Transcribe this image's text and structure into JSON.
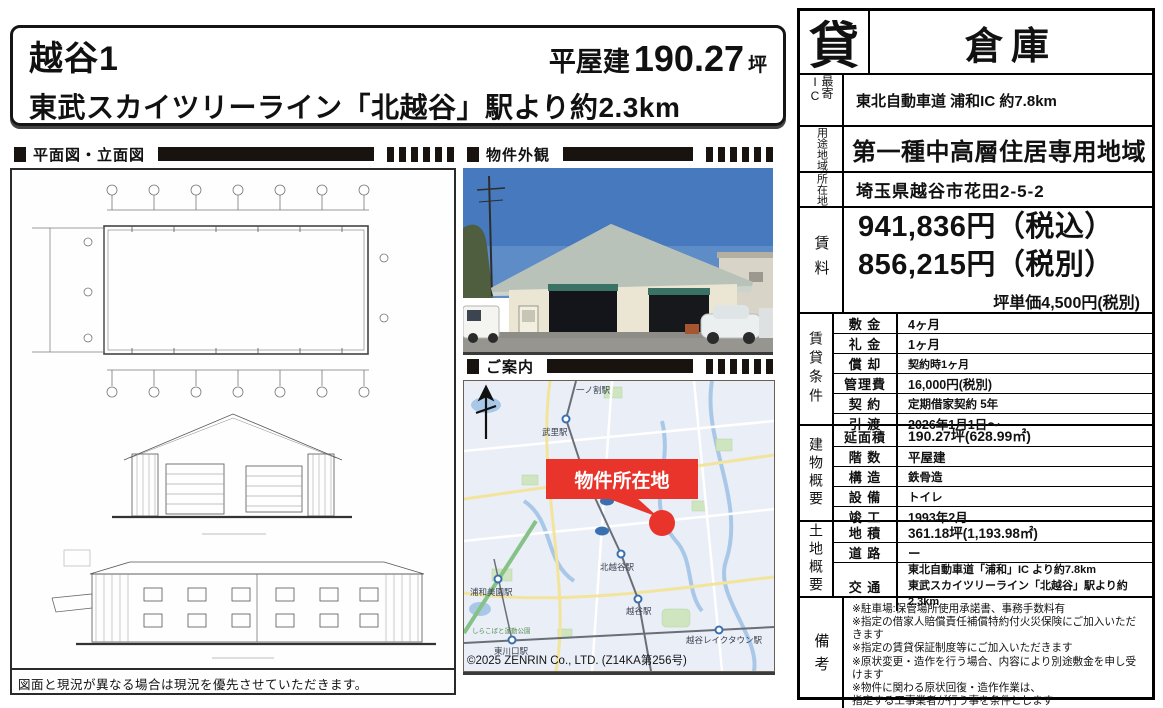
{
  "header": {
    "title": "越谷1",
    "building_type": "平屋建",
    "area_value": "190.27",
    "area_unit": "坪",
    "subtitle": "東武スカイツリーライン「北越谷」駅より約2.3km"
  },
  "sections": {
    "plan": {
      "title": "平面図・立面図",
      "note": "図面と現況が異なる場合は現況を優先させていただきます。"
    },
    "photo": {
      "title": "物件外観"
    },
    "map": {
      "title": "ご案内"
    }
  },
  "map": {
    "callout": "物件所在地",
    "copyright": "©2025 ZENRIN Co., LTD.  (Z14KA第256号)",
    "stations": [
      "一ノ割駅",
      "武里駅",
      "北越谷駅",
      "越谷駅",
      "浦和美園駅",
      "東川口駅",
      "越谷レイクタウン駅"
    ],
    "places": [
      "しらこばと運動公園"
    ]
  },
  "colors": {
    "accent_red": "#e8342b",
    "bar_black": "#191310"
  },
  "table": {
    "badge": "貸",
    "category": "倉庫",
    "nearest_ic": {
      "label": "最寄IC",
      "value": "東北自動車道 浦和IC 約7.8km"
    },
    "zoning": {
      "label": "用途地域",
      "value": "第一種中高層住居専用地域"
    },
    "address": {
      "label": "所在地",
      "value": "埼玉県越谷市花田2-5-2"
    },
    "rent": {
      "label": "賃料",
      "incl_tax": "941,836円（税込）",
      "excl_tax": "856,215円（税別）",
      "unit_price": "坪単価4,500円(税別)"
    },
    "lease": {
      "label": "賃貸条件",
      "rows": [
        {
          "label": "敷 金",
          "value": "4ヶ月"
        },
        {
          "label": "礼 金",
          "value": "1ヶ月"
        },
        {
          "label": "償 却",
          "value": "契約時1ヶ月"
        },
        {
          "label": "管理費",
          "value": "16,000円(税別)"
        },
        {
          "label": "契 約",
          "value": "定期借家契約 5年"
        },
        {
          "label": "引 渡",
          "value": "2026年1月1日〜"
        }
      ]
    },
    "building": {
      "label": "建物概要",
      "rows": [
        {
          "label": "延面積",
          "value": "190.27坪(628.99㎡)"
        },
        {
          "label": "階 数",
          "value": "平屋建"
        },
        {
          "label": "構 造",
          "value": "鉄骨造"
        },
        {
          "label": "設 備",
          "value": "トイレ"
        },
        {
          "label": "竣 工",
          "value": "1993年2月"
        }
      ]
    },
    "land": {
      "label": "土地概要",
      "rows": [
        {
          "label": "地 積",
          "value": "361.18坪(1,193.98㎡)"
        },
        {
          "label": "道 路",
          "value": "ー"
        },
        {
          "label": "交 通",
          "value": "東北自動車道「浦和」IC より約7.8km",
          "value2": "東武スカイツリーライン「北越谷」駅より約2.3km"
        }
      ]
    },
    "remarks": {
      "label": "備考",
      "lines": [
        "※駐車場:保管場所使用承諾書、事務手数料有",
        "※指定の借家人賠償責任補償特約付火災保険にご加入いただきます",
        "※指定の賃貸保証制度等にご加入いただきます",
        "※原状変更・造作を行う場合、内容により別途敷金を申し受けます",
        "※物件に関わる原状回復・造作作業は、",
        "指定する工事業者が行う事を条件とします"
      ]
    }
  }
}
